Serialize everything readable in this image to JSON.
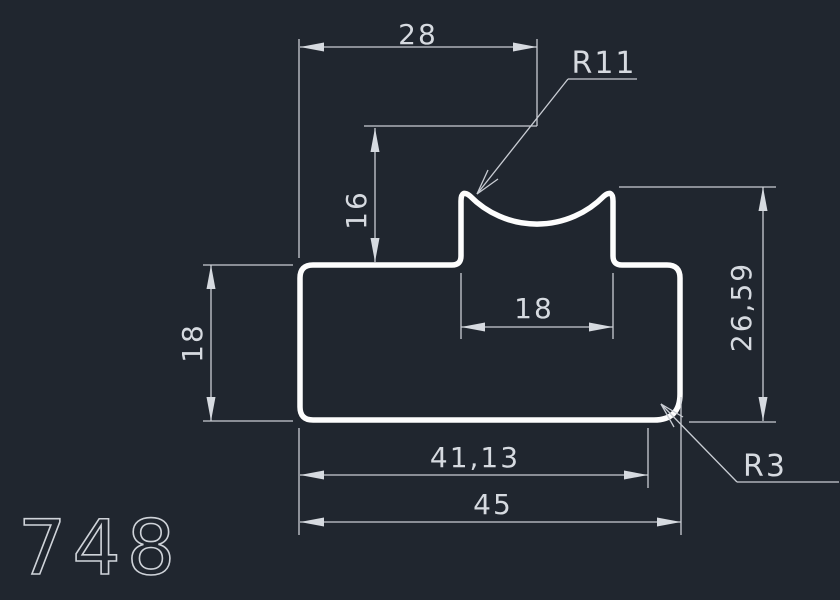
{
  "part_number": "748",
  "colors": {
    "background": "#20262f",
    "profile_outline": "#fdfdfd",
    "dimension_lines": "#c9cdd4",
    "dimension_text": "#d6dae0"
  },
  "dimensions": {
    "top_width": "28",
    "groove_center_height": "16",
    "boss_width": "18",
    "right_height": "26,59",
    "left_height": "18",
    "bottom_width_inner": "41,13",
    "bottom_width_total": "45",
    "groove_radius": "R11",
    "corner_radius": "R3"
  }
}
